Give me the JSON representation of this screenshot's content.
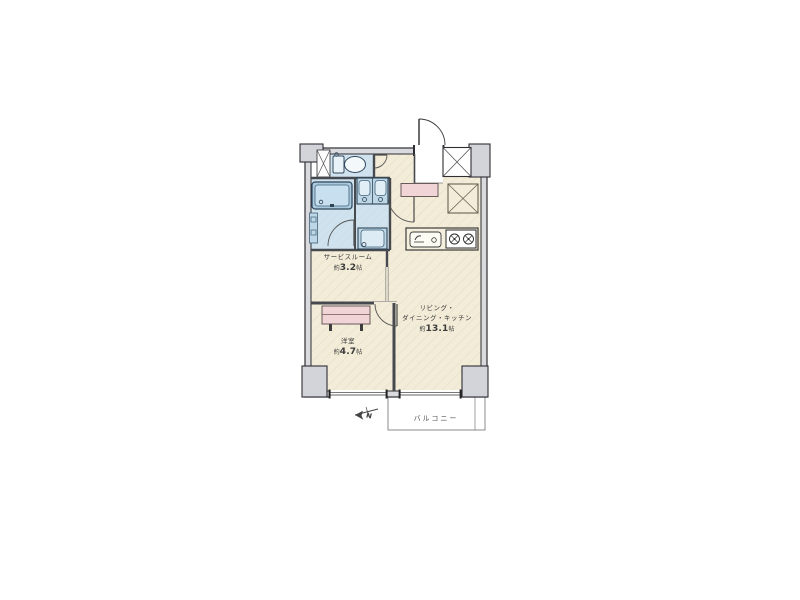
{
  "floorplan": {
    "service_room": {
      "name": "サービスルーム",
      "area_prefix": "約",
      "area_value": "3.2",
      "area_unit": "帖"
    },
    "bedroom": {
      "name": "洋室",
      "area_prefix": "約",
      "area_value": "4.7",
      "area_unit": "帖"
    },
    "ldk": {
      "name_line1": "リビング・",
      "name_line2": "ダイニング・キッチン",
      "area_prefix": "約",
      "area_value": "13.1",
      "area_unit": "帖"
    },
    "balcony": {
      "label": "バルコニー"
    },
    "compass": {
      "label": "N"
    },
    "colors": {
      "room_fill": "#f2ecd8",
      "wet_area_fill": "#cfe2ee",
      "fixture_fill": "#bdd7e6",
      "cabinet_fill": "#f0d4d6",
      "wall_fill": "#d9dade",
      "wall_line": "#2e2e33",
      "balcony_line": "#8b8b8b"
    }
  }
}
